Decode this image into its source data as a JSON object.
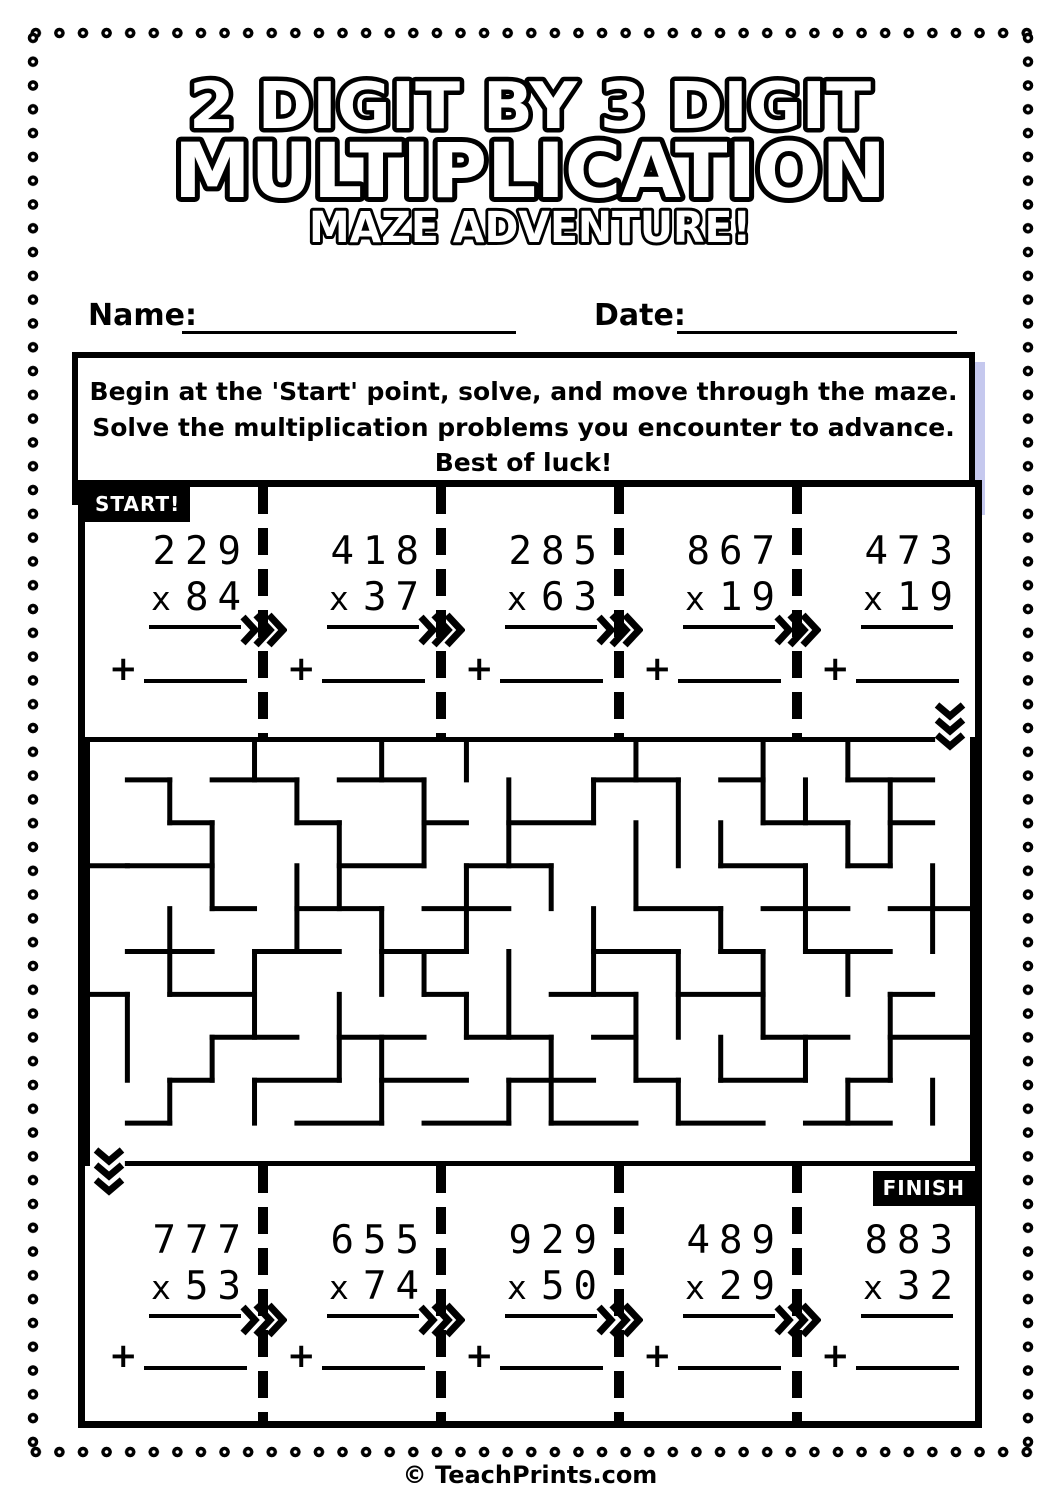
{
  "page": {
    "title_line1": "2 DIGIT BY 3 DIGIT",
    "title_line2": "MULTIPLICATION",
    "title_line3": "MAZE ADVENTURE!",
    "name_label": "Name:",
    "date_label": "Date:",
    "instructions": "Begin at the 'Start' point, solve, and move through the maze. Solve the multiplication problems you encounter to advance. Best of luck!",
    "start_label": "START!",
    "finish_label": "FINISH",
    "footer": "© TeachPrints.com"
  },
  "colors": {
    "ink": "#000000",
    "paper": "#ffffff",
    "instruction_shadow": "#c5c8ee"
  },
  "problems": {
    "op": "x",
    "plus": "+",
    "top": [
      {
        "a": "229",
        "b": "84"
      },
      {
        "a": "418",
        "b": "37"
      },
      {
        "a": "285",
        "b": "63"
      },
      {
        "a": "867",
        "b": "19"
      },
      {
        "a": "473",
        "b": "19"
      }
    ],
    "bottom": [
      {
        "a": "777",
        "b": "53"
      },
      {
        "a": "655",
        "b": "74"
      },
      {
        "a": "929",
        "b": "50"
      },
      {
        "a": "489",
        "b": "29"
      },
      {
        "a": "883",
        "b": "32"
      }
    ]
  },
  "maze": {
    "cols": 21,
    "rows": 10,
    "entrance": "top-right",
    "exit": "bottom-left",
    "walls_h": [
      [
        0,
        0,
        20
      ],
      [
        10,
        1,
        21
      ],
      [
        1,
        1,
        2
      ],
      [
        1,
        3,
        5
      ],
      [
        1,
        6,
        8
      ],
      [
        1,
        12,
        14
      ],
      [
        1,
        15,
        16
      ],
      [
        1,
        18,
        20
      ],
      [
        2,
        2,
        3
      ],
      [
        2,
        5,
        6
      ],
      [
        2,
        8,
        9
      ],
      [
        2,
        10,
        12
      ],
      [
        2,
        16,
        18
      ],
      [
        2,
        19,
        20
      ],
      [
        3,
        0,
        1
      ],
      [
        3,
        1,
        3
      ],
      [
        3,
        6,
        8
      ],
      [
        3,
        9,
        11
      ],
      [
        3,
        15,
        17
      ],
      [
        3,
        18,
        19
      ],
      [
        4,
        3,
        4
      ],
      [
        4,
        5,
        7
      ],
      [
        4,
        8,
        10
      ],
      [
        4,
        13,
        15
      ],
      [
        4,
        16,
        18
      ],
      [
        4,
        19,
        21
      ],
      [
        5,
        1,
        3
      ],
      [
        5,
        4,
        6
      ],
      [
        5,
        7,
        9
      ],
      [
        5,
        12,
        14
      ],
      [
        5,
        15,
        16
      ],
      [
        5,
        17,
        19
      ],
      [
        6,
        0,
        1
      ],
      [
        6,
        2,
        4
      ],
      [
        6,
        8,
        9
      ],
      [
        6,
        11,
        13
      ],
      [
        6,
        14,
        16
      ],
      [
        6,
        19,
        20
      ],
      [
        7,
        3,
        5
      ],
      [
        7,
        6,
        8
      ],
      [
        7,
        9,
        11
      ],
      [
        7,
        12,
        13
      ],
      [
        7,
        16,
        18
      ],
      [
        7,
        19,
        21
      ],
      [
        8,
        2,
        3
      ],
      [
        8,
        4,
        6
      ],
      [
        8,
        7,
        9
      ],
      [
        8,
        10,
        12
      ],
      [
        8,
        13,
        14
      ],
      [
        8,
        15,
        17
      ],
      [
        8,
        18,
        19
      ],
      [
        9,
        1,
        2
      ],
      [
        9,
        5,
        7
      ],
      [
        9,
        8,
        10
      ],
      [
        9,
        11,
        13
      ],
      [
        9,
        14,
        16
      ],
      [
        9,
        17,
        19
      ]
    ],
    "walls_v": [
      [
        0,
        0,
        10
      ],
      [
        21,
        0,
        10
      ],
      [
        1,
        6,
        8
      ],
      [
        2,
        1,
        2
      ],
      [
        2,
        4,
        6
      ],
      [
        2,
        8,
        9
      ],
      [
        3,
        2,
        4
      ],
      [
        3,
        7,
        8
      ],
      [
        4,
        0,
        1
      ],
      [
        4,
        5,
        7
      ],
      [
        4,
        8,
        9
      ],
      [
        5,
        1,
        2
      ],
      [
        5,
        3,
        5
      ],
      [
        6,
        2,
        4
      ],
      [
        6,
        6,
        8
      ],
      [
        7,
        0,
        1
      ],
      [
        7,
        4,
        6
      ],
      [
        7,
        7,
        9
      ],
      [
        8,
        1,
        3
      ],
      [
        8,
        5,
        6
      ],
      [
        9,
        0,
        1
      ],
      [
        9,
        3,
        5
      ],
      [
        9,
        6,
        7
      ],
      [
        10,
        1,
        3
      ],
      [
        10,
        5,
        7
      ],
      [
        10,
        8,
        9
      ],
      [
        11,
        3,
        4
      ],
      [
        11,
        7,
        9
      ],
      [
        12,
        1,
        2
      ],
      [
        12,
        4,
        6
      ],
      [
        13,
        0,
        1
      ],
      [
        13,
        2,
        4
      ],
      [
        13,
        6,
        8
      ],
      [
        14,
        1,
        3
      ],
      [
        14,
        5,
        7
      ],
      [
        14,
        8,
        9
      ],
      [
        15,
        2,
        3
      ],
      [
        15,
        4,
        5
      ],
      [
        15,
        7,
        8
      ],
      [
        16,
        0,
        2
      ],
      [
        16,
        5,
        7
      ],
      [
        17,
        1,
        2
      ],
      [
        17,
        3,
        5
      ],
      [
        17,
        7,
        8
      ],
      [
        18,
        0,
        1
      ],
      [
        18,
        2,
        3
      ],
      [
        18,
        5,
        6
      ],
      [
        18,
        8,
        9
      ],
      [
        19,
        1,
        3
      ],
      [
        19,
        6,
        8
      ],
      [
        20,
        3,
        5
      ],
      [
        20,
        8,
        9
      ]
    ]
  }
}
